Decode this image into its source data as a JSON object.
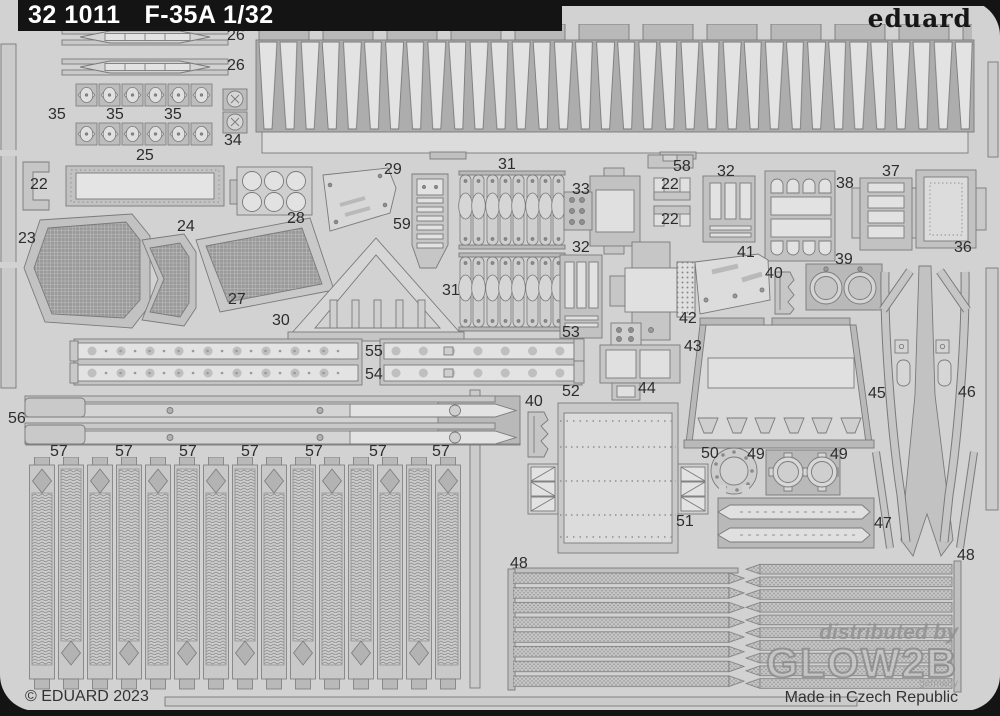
{
  "header": {
    "catalog_number": "32 1011",
    "product_title": "F-35A 1/32",
    "brand": "eduard"
  },
  "footer": {
    "copyright": "© EDUARD 2023",
    "made_in": "Made in Czech Republic"
  },
  "watermark": {
    "line1": "distributed by",
    "brand": "GLOW2B",
    "sub": "germany"
  },
  "sheet": {
    "colors": {
      "background": "#141414",
      "sheet": "#d2d2d2",
      "part_frame": "#c6c6c6",
      "etched_light": "#e0e0e0",
      "outline": "#7a7a7a",
      "mesh": "#9a9a9a"
    }
  },
  "part_labels": [
    {
      "text": "26",
      "x": 227,
      "y": 28
    },
    {
      "text": "26",
      "x": 227,
      "y": 58
    },
    {
      "text": "35",
      "x": 48,
      "y": 107
    },
    {
      "text": "35",
      "x": 106,
      "y": 107
    },
    {
      "text": "35",
      "x": 164,
      "y": 107
    },
    {
      "text": "34",
      "x": 224,
      "y": 133
    },
    {
      "text": "25",
      "x": 136,
      "y": 148
    },
    {
      "text": "22",
      "x": 30,
      "y": 177
    },
    {
      "text": "28",
      "x": 287,
      "y": 211
    },
    {
      "text": "23",
      "x": 18,
      "y": 231
    },
    {
      "text": "24",
      "x": 177,
      "y": 219
    },
    {
      "text": "27",
      "x": 228,
      "y": 292
    },
    {
      "text": "30",
      "x": 272,
      "y": 313
    },
    {
      "text": "29",
      "x": 384,
      "y": 162
    },
    {
      "text": "59",
      "x": 393,
      "y": 217
    },
    {
      "text": "31",
      "x": 498,
      "y": 157
    },
    {
      "text": "31",
      "x": 442,
      "y": 283
    },
    {
      "text": "33",
      "x": 572,
      "y": 182
    },
    {
      "text": "58",
      "x": 673,
      "y": 159
    },
    {
      "text": "22",
      "x": 661,
      "y": 177
    },
    {
      "text": "22",
      "x": 661,
      "y": 212
    },
    {
      "text": "32",
      "x": 717,
      "y": 164
    },
    {
      "text": "32",
      "x": 572,
      "y": 240
    },
    {
      "text": "38",
      "x": 836,
      "y": 176
    },
    {
      "text": "37",
      "x": 882,
      "y": 164
    },
    {
      "text": "36",
      "x": 954,
      "y": 240
    },
    {
      "text": "39",
      "x": 835,
      "y": 252
    },
    {
      "text": "41",
      "x": 737,
      "y": 245
    },
    {
      "text": "40",
      "x": 765,
      "y": 266
    },
    {
      "text": "40",
      "x": 525,
      "y": 394
    },
    {
      "text": "42",
      "x": 679,
      "y": 311
    },
    {
      "text": "43",
      "x": 684,
      "y": 339
    },
    {
      "text": "44",
      "x": 638,
      "y": 381
    },
    {
      "text": "53",
      "x": 562,
      "y": 325
    },
    {
      "text": "55",
      "x": 365,
      "y": 344
    },
    {
      "text": "54",
      "x": 365,
      "y": 367
    },
    {
      "text": "52",
      "x": 562,
      "y": 384
    },
    {
      "text": "56",
      "x": 8,
      "y": 411
    },
    {
      "text": "45",
      "x": 868,
      "y": 386
    },
    {
      "text": "46",
      "x": 958,
      "y": 385
    },
    {
      "text": "47",
      "x": 874,
      "y": 516
    },
    {
      "text": "50",
      "x": 701,
      "y": 446
    },
    {
      "text": "49",
      "x": 747,
      "y": 447
    },
    {
      "text": "49",
      "x": 830,
      "y": 447
    },
    {
      "text": "51",
      "x": 676,
      "y": 514
    },
    {
      "text": "48",
      "x": 510,
      "y": 556
    },
    {
      "text": "48",
      "x": 957,
      "y": 548
    },
    {
      "text": "57",
      "x": 50,
      "y": 444
    },
    {
      "text": "57",
      "x": 115,
      "y": 444
    },
    {
      "text": "57",
      "x": 179,
      "y": 444
    },
    {
      "text": "57",
      "x": 241,
      "y": 444
    },
    {
      "text": "57",
      "x": 305,
      "y": 444
    },
    {
      "text": "57",
      "x": 369,
      "y": 444
    },
    {
      "text": "57",
      "x": 432,
      "y": 444
    }
  ]
}
